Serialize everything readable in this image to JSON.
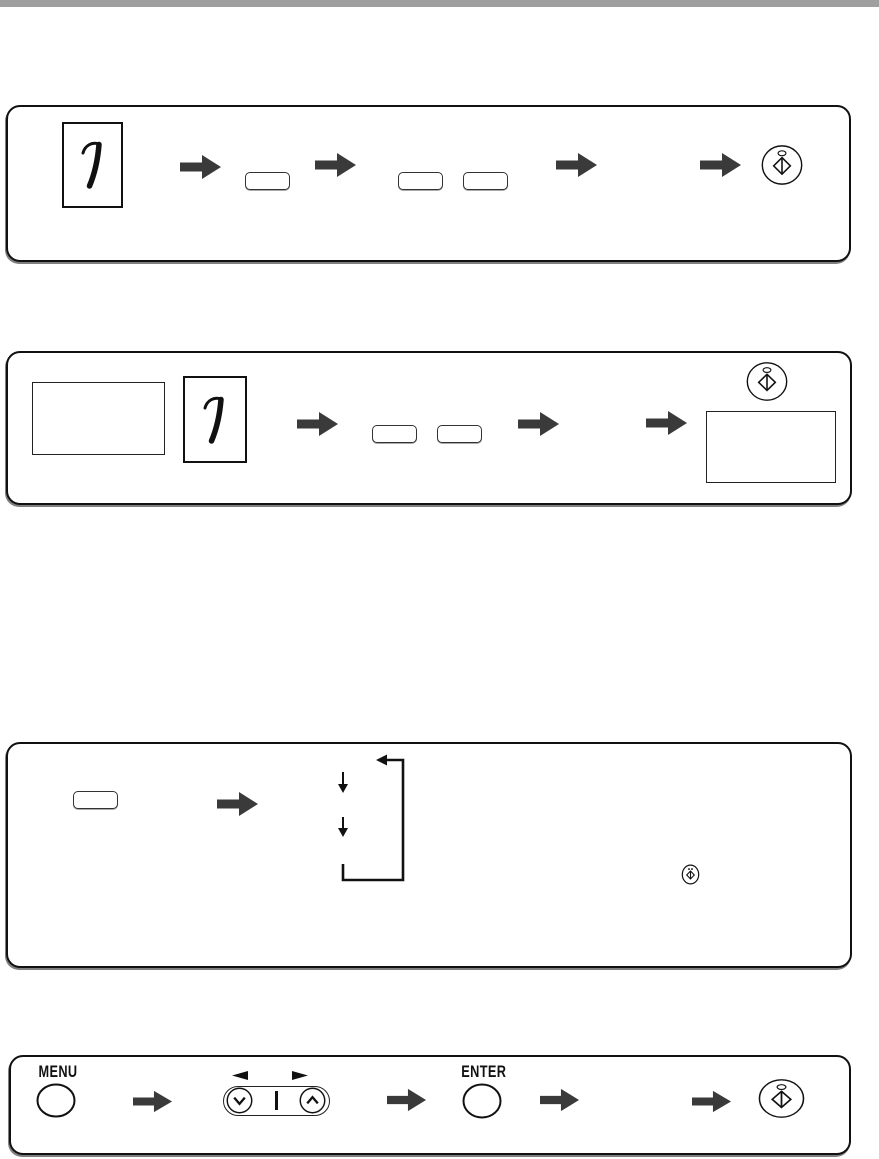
{
  "page": {
    "top_bar_color": "#9f9f9f",
    "background": "#ffffff"
  },
  "colors": {
    "arrow": "#3a3a3a",
    "outline": "#111111"
  },
  "labels": {
    "menu": "MENU",
    "enter": "ENTER",
    "original_numeral": "1"
  },
  "flows": [
    {
      "name": "flow-1-original-key-keys-start",
      "icons": [
        "original-page-1",
        "block-arrow",
        "key-button",
        "block-arrow",
        "key-button",
        "key-button",
        "block-arrow",
        "block-arrow",
        "start-button"
      ]
    },
    {
      "name": "flow-2-platen-original-keys-start",
      "icons": [
        "blank-box",
        "original-page-1",
        "block-arrow",
        "key-button",
        "key-button",
        "block-arrow",
        "block-arrow",
        "start-button",
        "blank-box"
      ]
    },
    {
      "name": "flow-3-key-then-cycle",
      "icons": [
        "key-button",
        "block-arrow",
        "down-arrow",
        "down-arrow",
        "loop-back-arrow",
        "start-button-small"
      ]
    },
    {
      "name": "flow-4-menu-select-enter-start",
      "icons": [
        "menu-button",
        "block-arrow",
        "left-triangle",
        "right-triangle",
        "scroll-down-button",
        "scroll-up-button",
        "block-arrow",
        "enter-button",
        "block-arrow",
        "block-arrow",
        "start-button"
      ]
    }
  ]
}
